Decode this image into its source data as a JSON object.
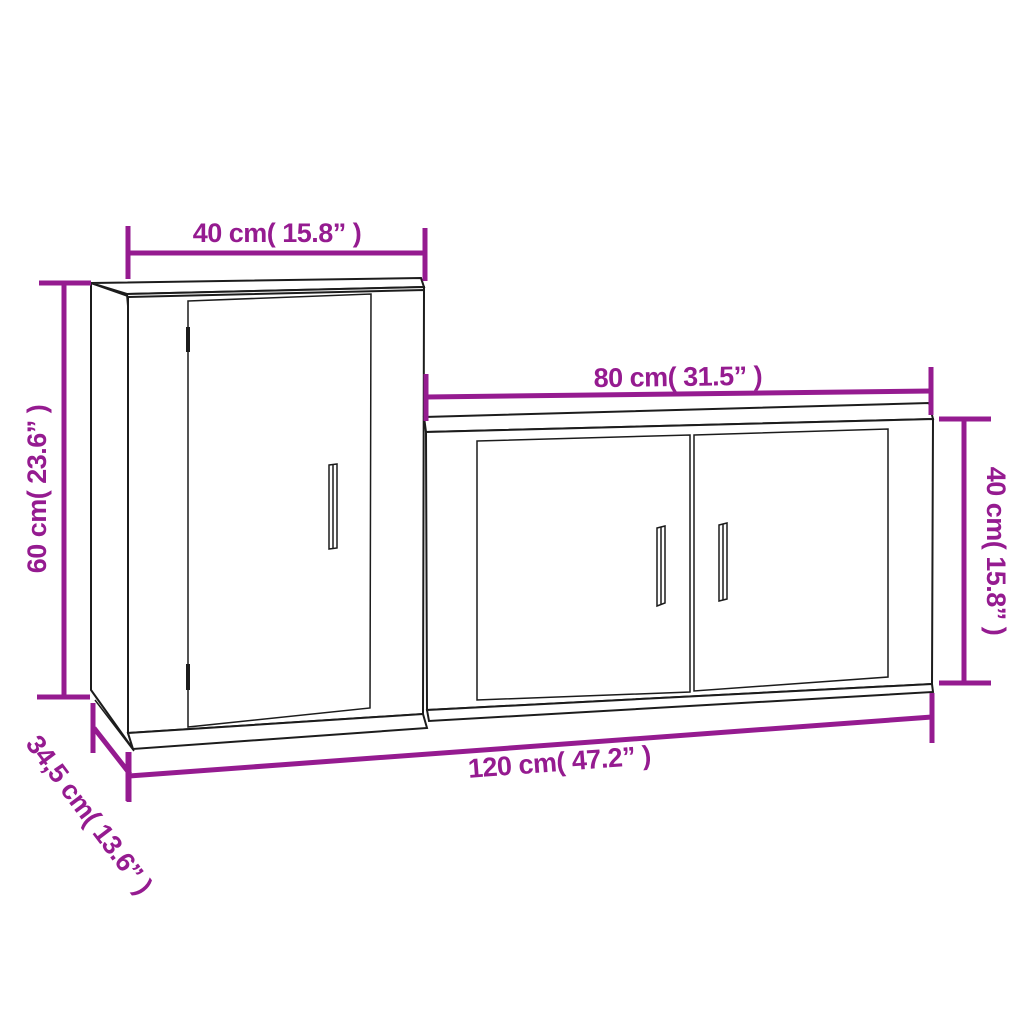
{
  "diagram": {
    "kind": "furniture dimension drawing",
    "pieces": [
      "tall wall cabinet",
      "wide wall cabinet"
    ]
  },
  "colors": {
    "dimension_annotation": "#951b90",
    "outline": "#1c1c1c",
    "background": "#ffffff"
  },
  "dimensions": {
    "tall_cabinet_width": {
      "label": "40 cm( 15.8” )",
      "cm": 40,
      "inch": 15.8
    },
    "tall_cabinet_height": {
      "label": "60 cm( 23.6” )",
      "cm": 60,
      "inch": 23.6
    },
    "wide_cabinet_width": {
      "label": "80 cm( 31.5” )",
      "cm": 80,
      "inch": 31.5
    },
    "wide_cabinet_height": {
      "label": "40 cm( 15.8” )",
      "cm": 40,
      "inch": 15.8
    },
    "total_width": {
      "label": "120 cm( 47.2” )",
      "cm": 120,
      "inch": 47.2
    },
    "depth": {
      "label": "34,5 cm( 13.6” )",
      "cm": 34.5,
      "inch": 13.6
    }
  }
}
